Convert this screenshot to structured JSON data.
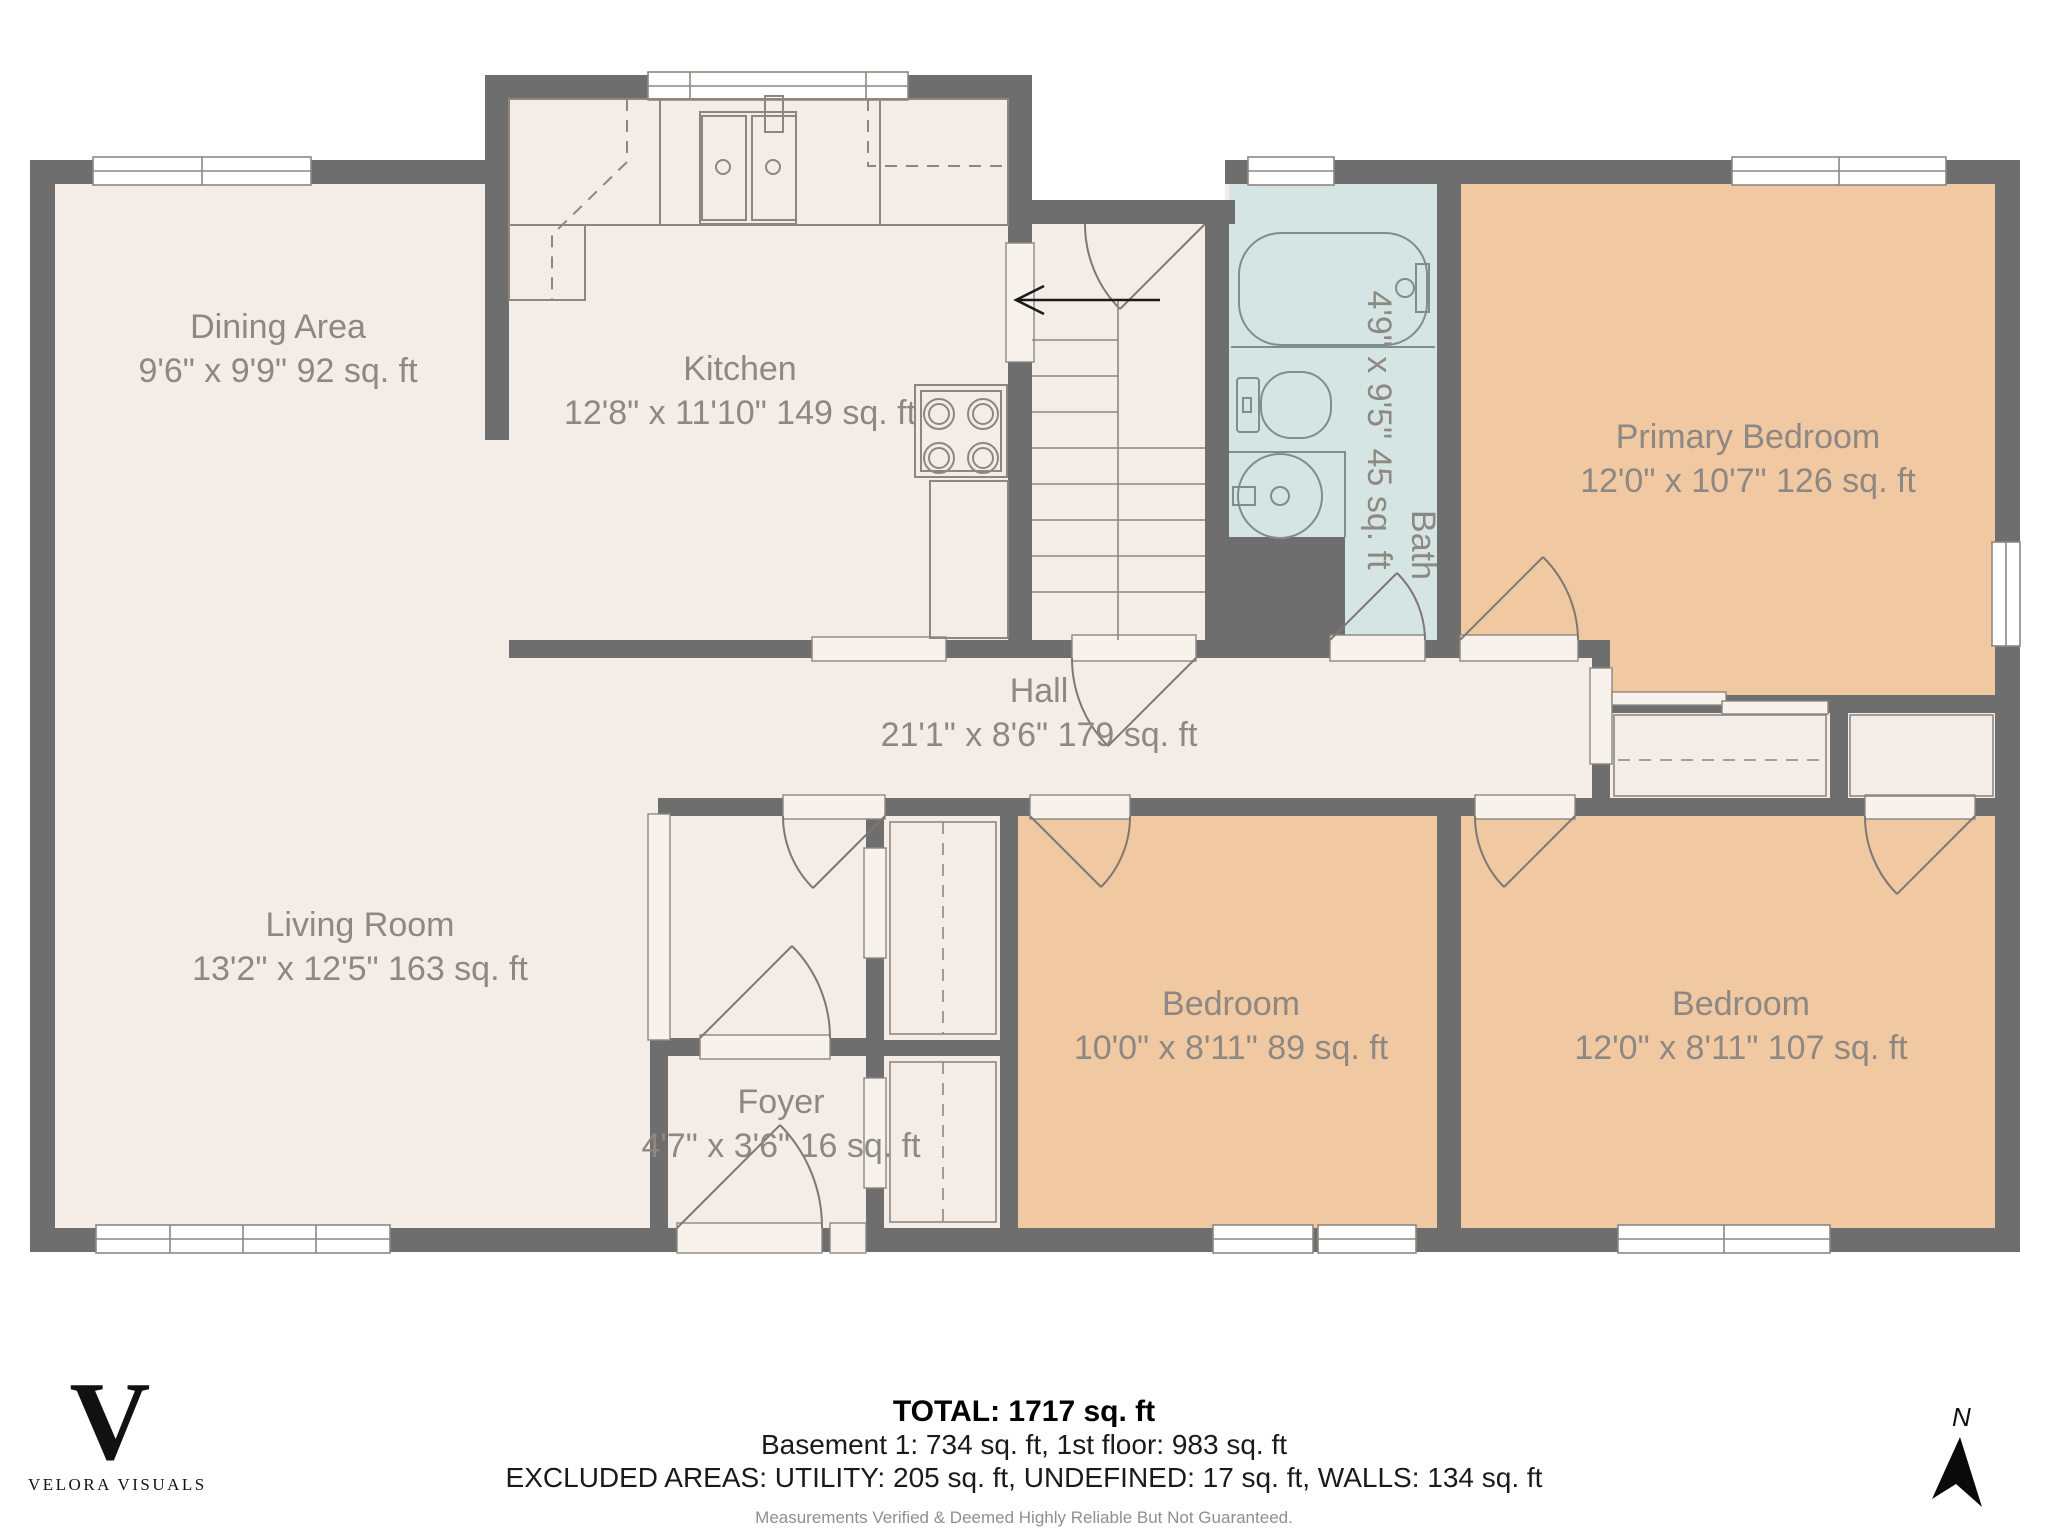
{
  "plan_title_rooms_note": "first floor residential floor plan",
  "rooms": [
    {
      "id": "dining",
      "name": "Dining Area",
      "dims": "9'6\" x 9'9\" 92 sq. ft"
    },
    {
      "id": "kitchen",
      "name": "Kitchen",
      "dims": "12'8\" x 11'10\" 149 sq. ft"
    },
    {
      "id": "bath",
      "name": "Bath",
      "dims": "4'9\" x 9'5\" 45 sq. ft"
    },
    {
      "id": "primary_bedroom",
      "name": "Primary Bedroom",
      "dims": "12'0\" x 10'7\" 126 sq. ft"
    },
    {
      "id": "hall",
      "name": "Hall",
      "dims": "21'1\" x 8'6\" 179 sq. ft"
    },
    {
      "id": "living_room",
      "name": "Living Room",
      "dims": "13'2\" x 12'5\" 163 sq. ft"
    },
    {
      "id": "foyer",
      "name": "Foyer",
      "dims": "4'7\" x 3'6\" 16 sq. ft"
    },
    {
      "id": "bedroom_middle",
      "name": "Bedroom",
      "dims": "10'0\" x 8'11\" 89 sq. ft"
    },
    {
      "id": "bedroom_right",
      "name": "Bedroom",
      "dims": "12'0\" x 8'11\" 107 sq. ft"
    }
  ],
  "fixtures": [
    "kitchen-sink",
    "stove",
    "base-cabinet",
    "bathtub",
    "toilet",
    "bathroom-sink",
    "stairs",
    "closets"
  ],
  "stairs": {
    "direction_arrow": "left"
  },
  "footer": {
    "total": "TOTAL: 1717 sq. ft",
    "floors": "Basement 1: 734 sq. ft, 1st floor: 983 sq. ft",
    "excluded": "EXCLUDED AREAS: UTILITY: 205 sq. ft, UNDEFINED: 17 sq. ft, WALLS: 134 sq. ft",
    "disclaimer": "Measurements Verified & Deemed Highly Reliable But Not Guaranteed."
  },
  "branding": {
    "logo_letter": "V",
    "logo_name": "VELORA VISUALS"
  },
  "compass": {
    "label": "N"
  },
  "colors": {
    "wall": "#6e6e6e",
    "floor": "#f4ede7",
    "bedroom_fill": "#f0c8a2",
    "bathroom_fill": "#d5e5e4",
    "fixture_outline": "#8d877f",
    "label_text": "#8e8883"
  }
}
